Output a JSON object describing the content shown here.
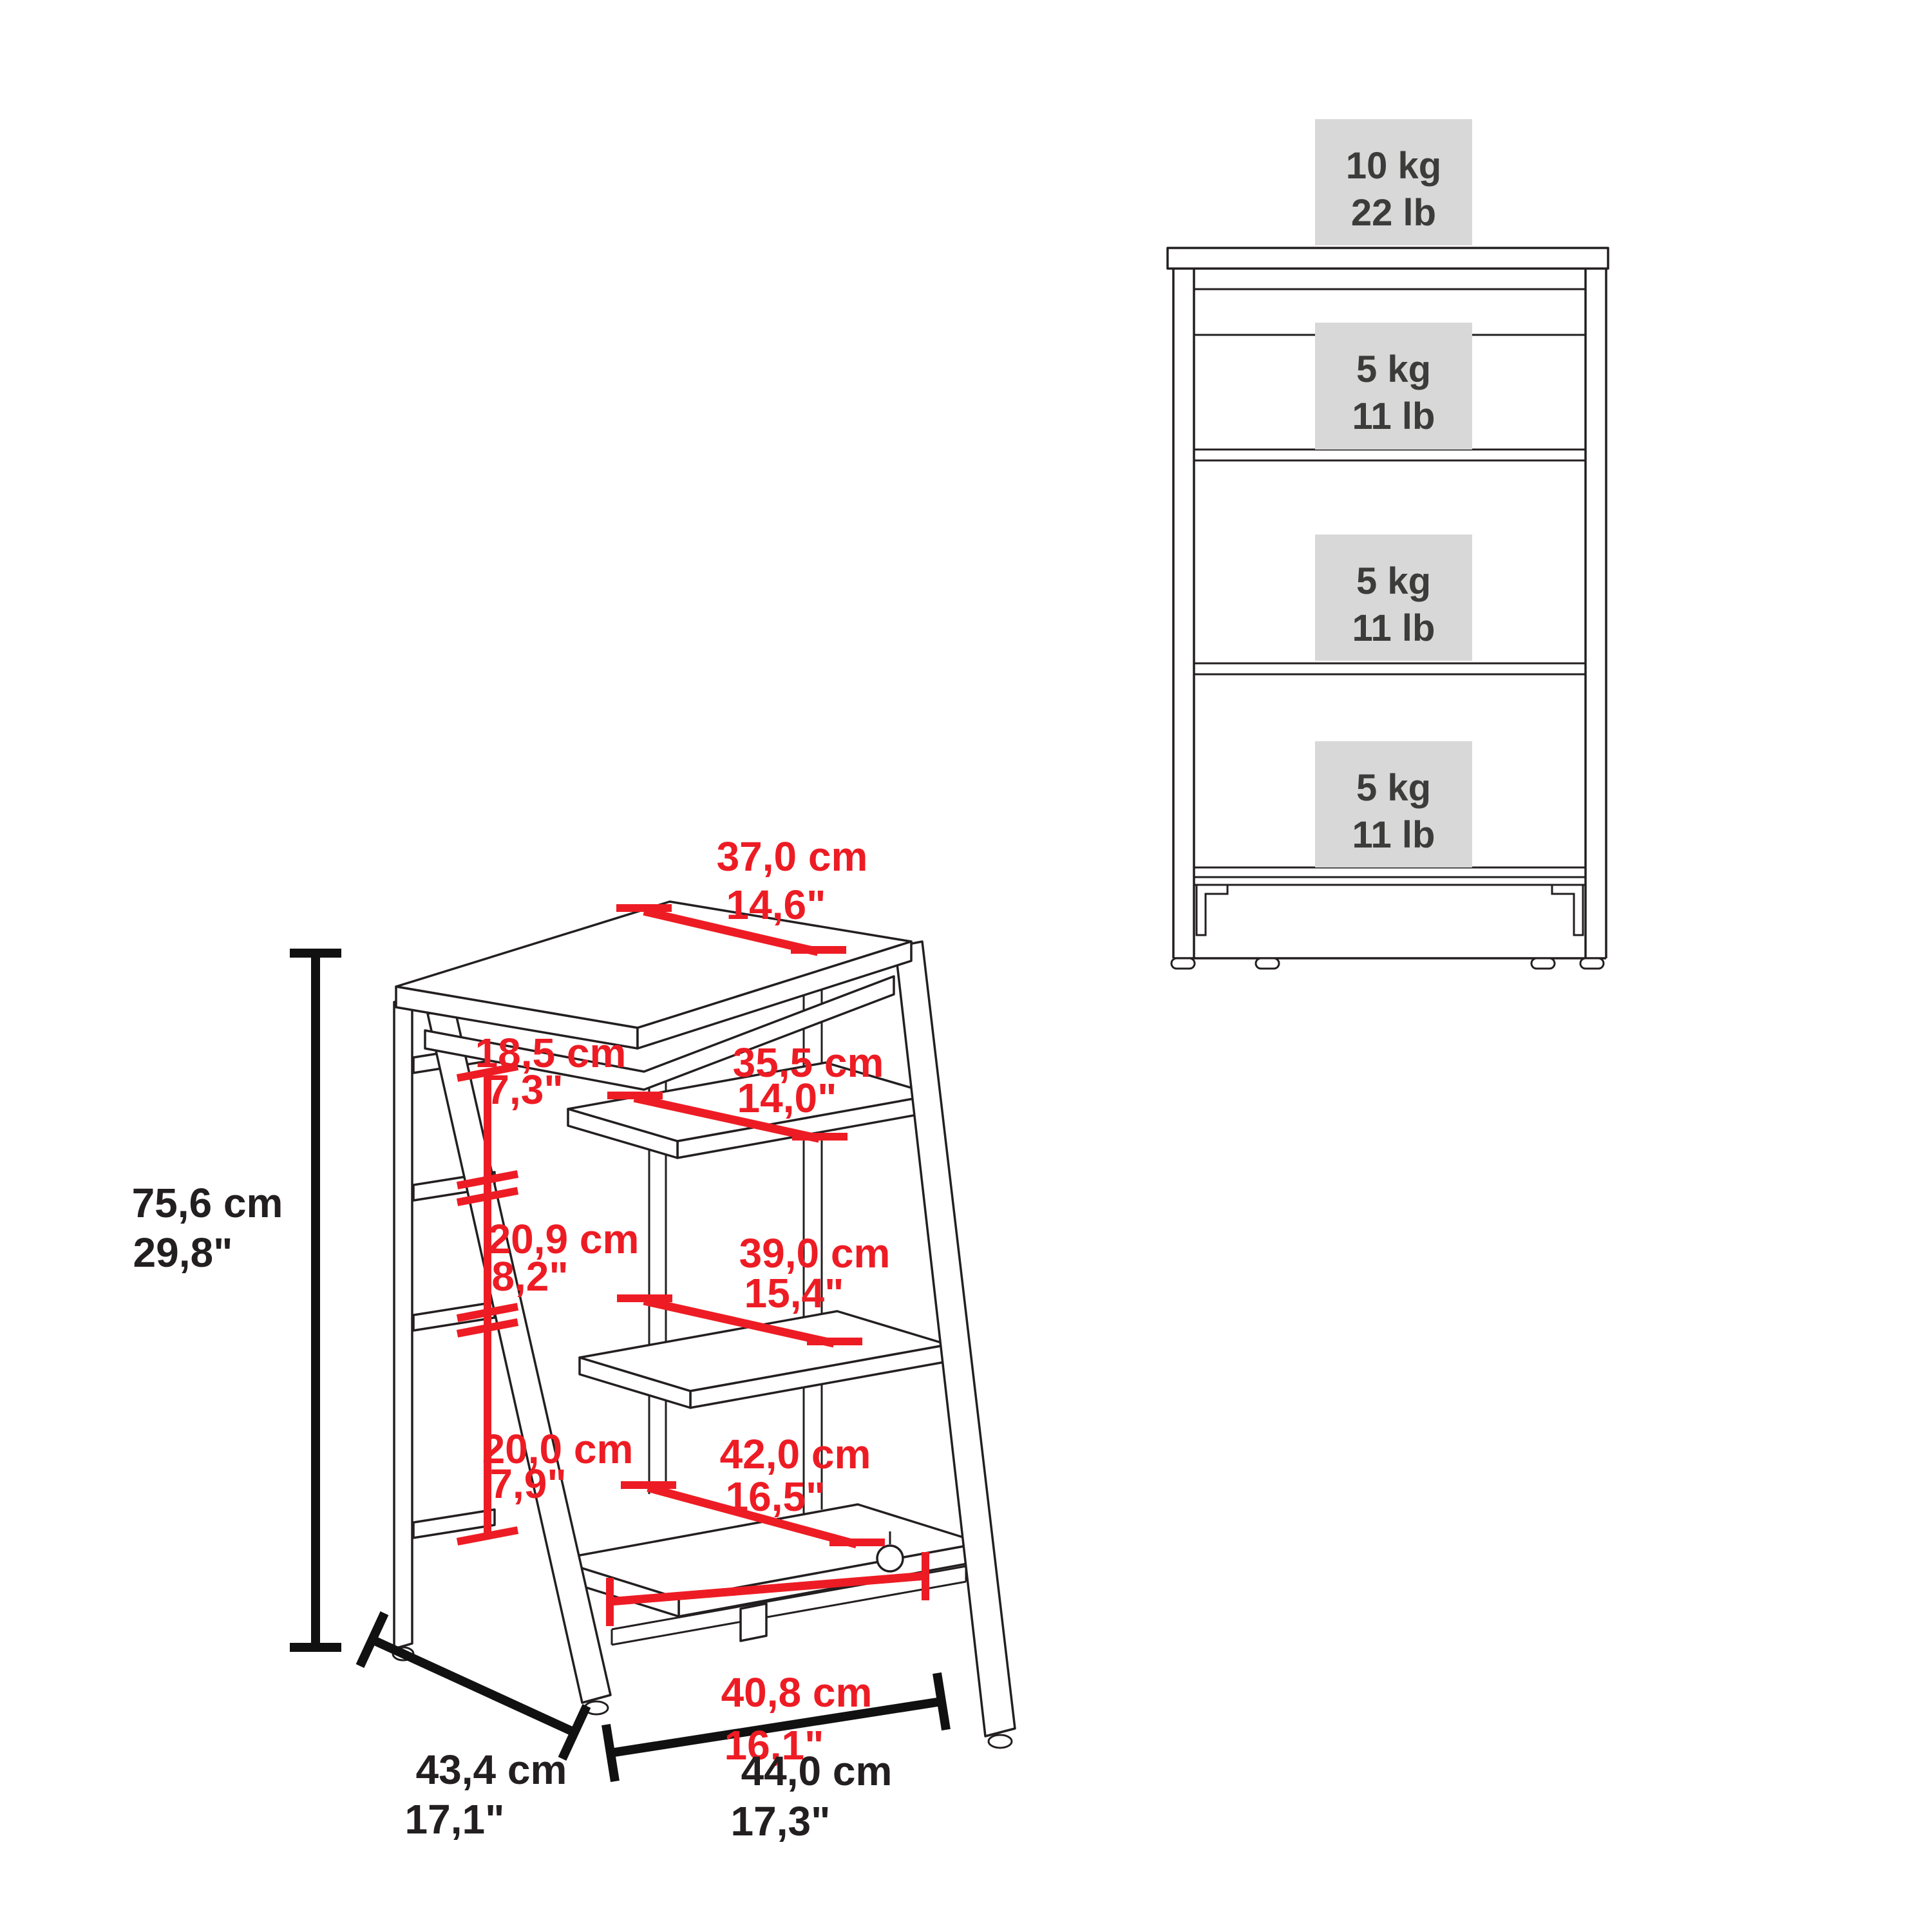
{
  "diagram_type": "furniture-dimension-spec",
  "colors": {
    "background": "#ffffff",
    "outline": "#231f20",
    "dimension_red": "#ed1c24",
    "dimension_black": "#111111",
    "load_box_bg": "#d8d8d8",
    "load_text": "#3c3c3b"
  },
  "front_view": {
    "load_ratings": [
      {
        "kg": "10 kg",
        "lb": "22 lb",
        "location": "top-surface"
      },
      {
        "kg": "5 kg",
        "lb": "11 lb",
        "location": "shelf-1"
      },
      {
        "kg": "5 kg",
        "lb": "11 lb",
        "location": "shelf-2"
      },
      {
        "kg": "5 kg",
        "lb": "11 lb",
        "location": "shelf-3"
      }
    ]
  },
  "iso_view": {
    "dims": {
      "top_depth": {
        "cm": "37,0 cm",
        "inch": "14,6\""
      },
      "height": {
        "cm": "75,6 cm",
        "inch": "29,8\""
      },
      "opening1": {
        "cm": "18,5 cm",
        "inch": "7,3\""
      },
      "shelf1_depth": {
        "cm": "35,5 cm",
        "inch": "14,0\""
      },
      "opening2": {
        "cm": "20,9 cm",
        "inch": "8,2\""
      },
      "shelf2_depth": {
        "cm": "39,0 cm",
        "inch": "15,4\""
      },
      "opening3": {
        "cm": "20,0 cm",
        "inch": "7,9\""
      },
      "shelf3_depth": {
        "cm": "42,0 cm",
        "inch": "16,5\""
      },
      "bottom_width": {
        "cm": "40,8 cm",
        "inch": "16,1\""
      },
      "depth": {
        "cm": "43,4 cm",
        "inch": "17,1\""
      },
      "width": {
        "cm": "44,0 cm",
        "inch": "17,3\""
      }
    }
  }
}
